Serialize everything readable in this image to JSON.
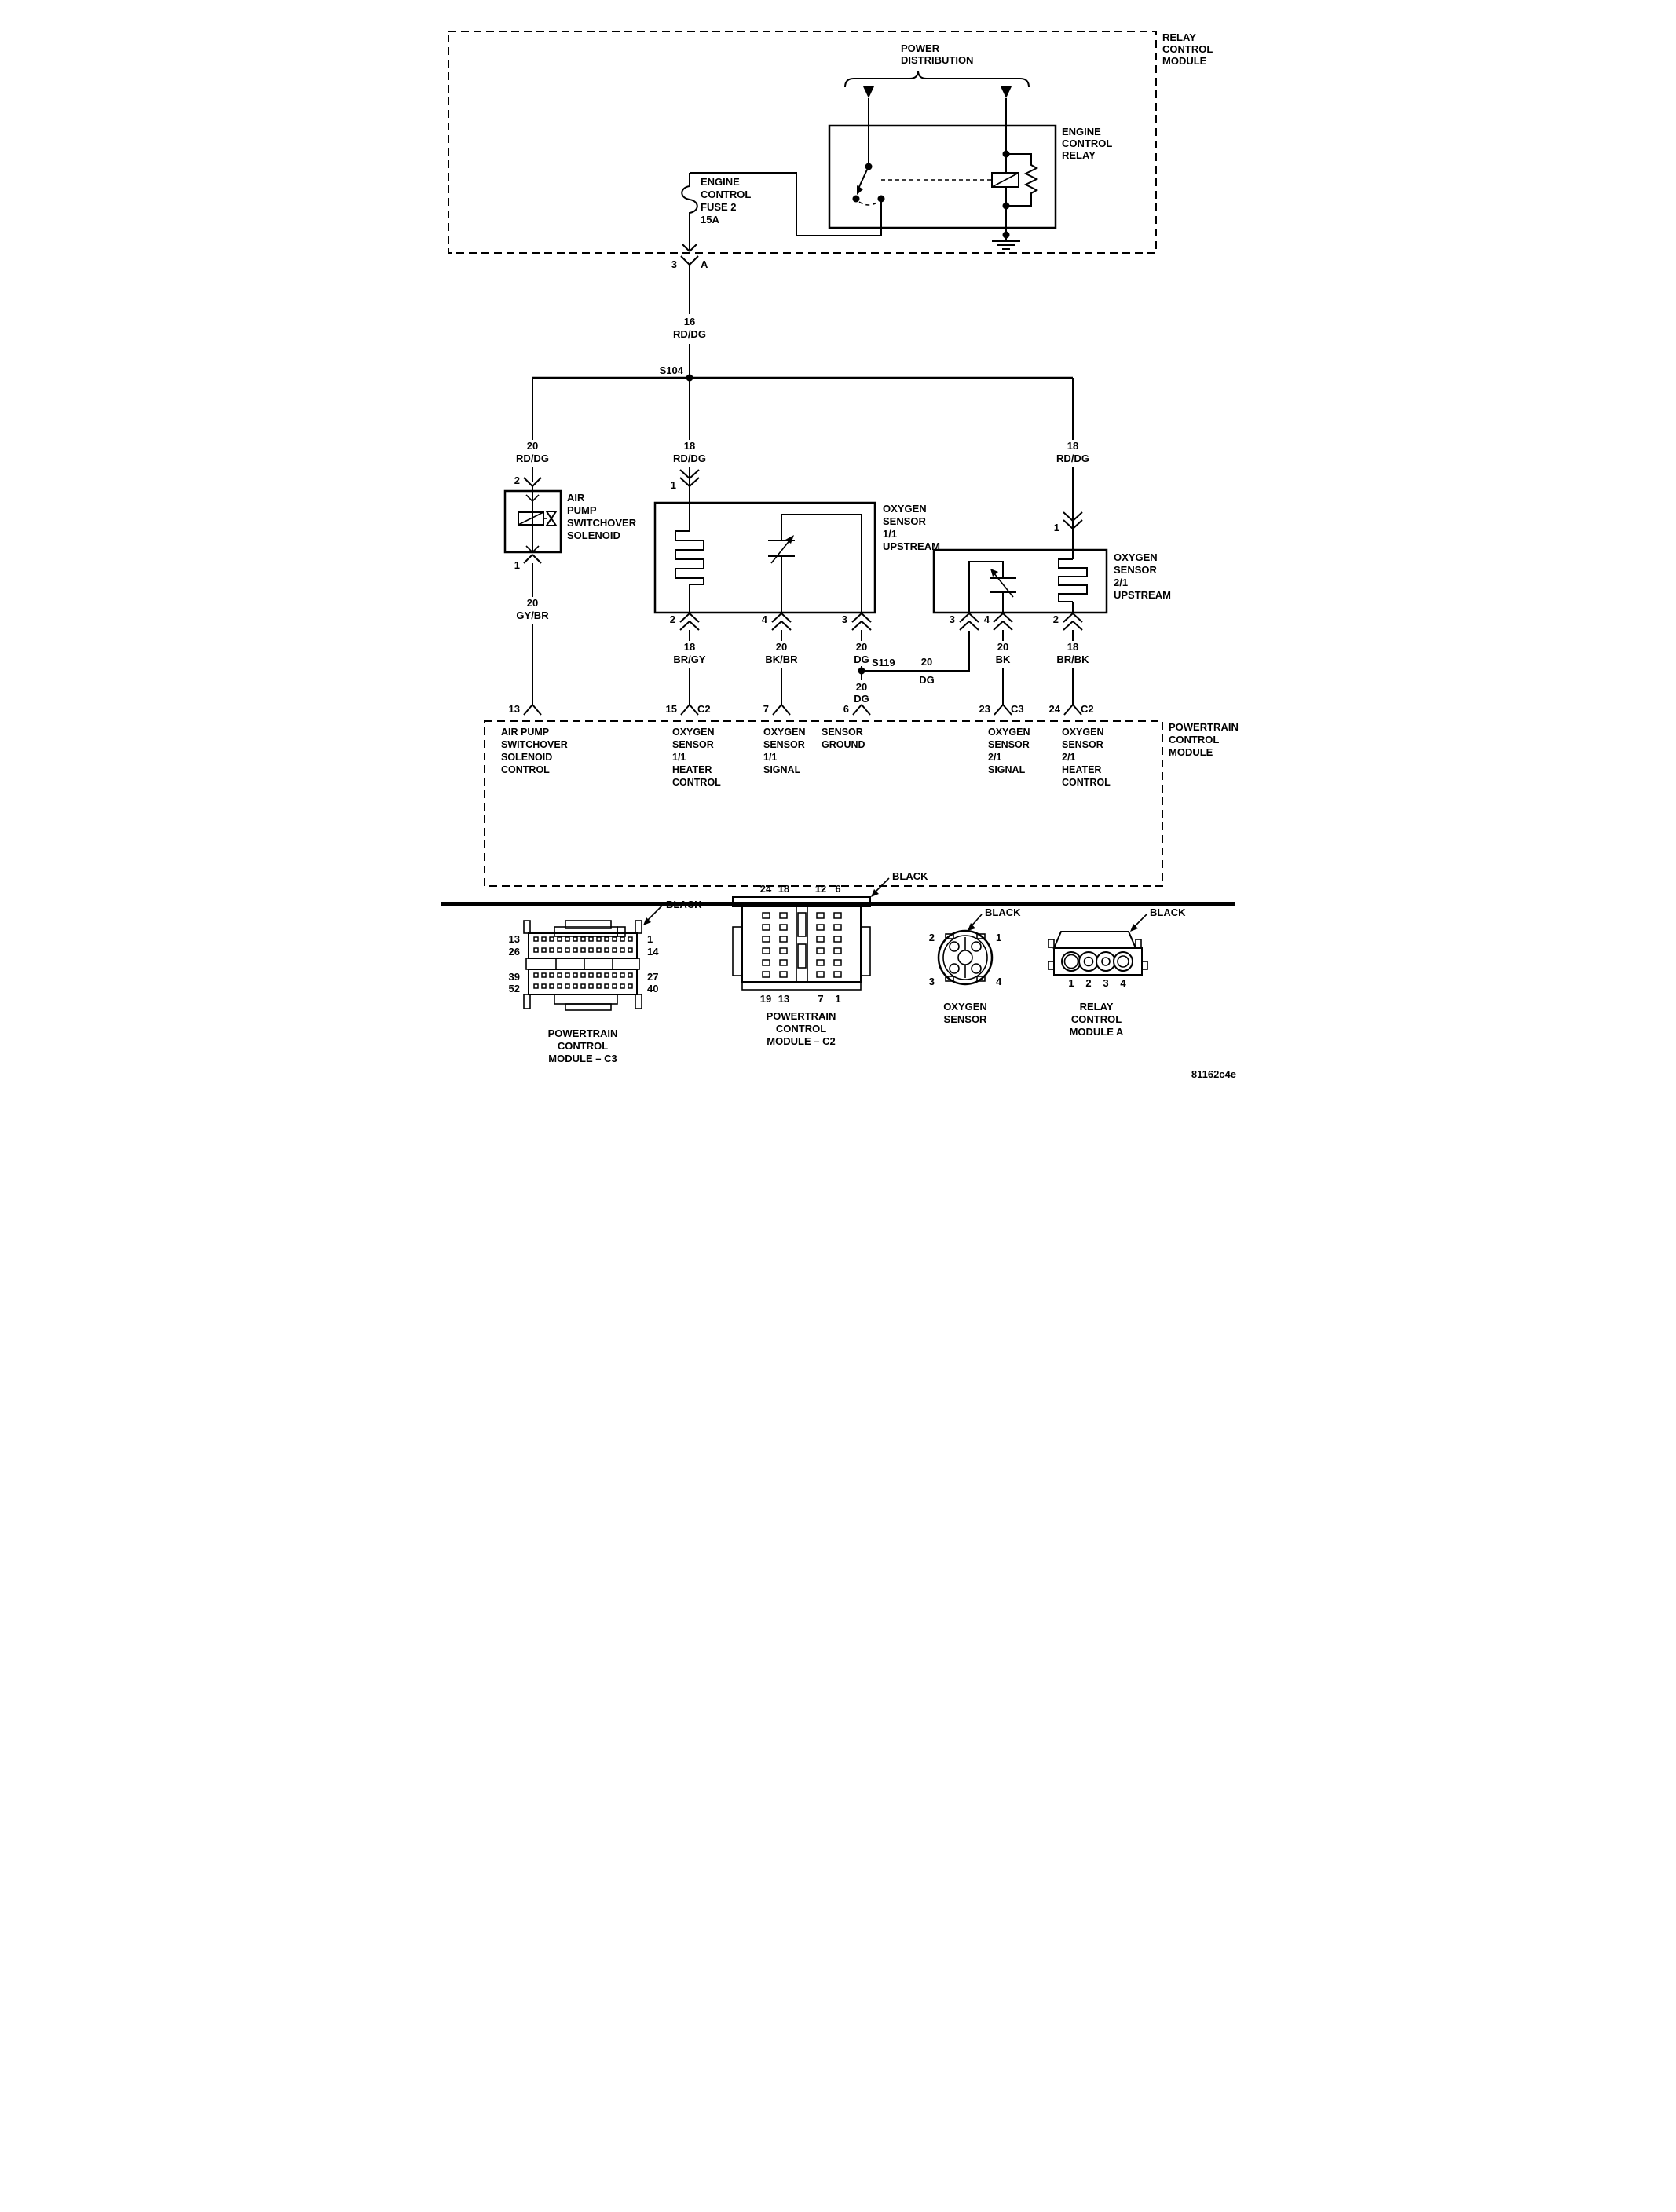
{
  "diagram_code": "81162c4e",
  "relay_control_module": {
    "label": [
      "RELAY",
      "CONTROL",
      "MODULE"
    ]
  },
  "power_distribution": {
    "label": [
      "POWER",
      "DISTRIBUTION"
    ]
  },
  "engine_control_relay": {
    "label": [
      "ENGINE",
      "CONTROL",
      "RELAY"
    ]
  },
  "fuse": {
    "label": [
      "ENGINE",
      "CONTROL",
      "FUSE 2",
      "15A"
    ],
    "exit_pin": "3",
    "exit_cavity": "A"
  },
  "splices": {
    "s104": "S104",
    "s119": "S119"
  },
  "wires": {
    "w16rddg": {
      "gauge": "16",
      "color": "RD/DG"
    },
    "w20rddg": {
      "gauge": "20",
      "color": "RD/DG"
    },
    "w18rddg_mid": {
      "gauge": "18",
      "color": "RD/DG"
    },
    "w18rddg_right": {
      "gauge": "18",
      "color": "RD/DG"
    },
    "w20gybr": {
      "gauge": "20",
      "color": "GY/BR"
    },
    "w18brgy": {
      "gauge": "18",
      "color": "BR/GY"
    },
    "w20bkbr": {
      "gauge": "20",
      "color": "BK/BR"
    },
    "w20dg_a": {
      "gauge": "20",
      "color": "DG"
    },
    "w20dg_b": {
      "gauge": "20",
      "color": "DG"
    },
    "w20dg_c": {
      "gauge": "20",
      "color": "DG"
    },
    "w20bk": {
      "gauge": "20",
      "color": "BK"
    },
    "w18brbk": {
      "gauge": "18",
      "color": "BR/BK"
    }
  },
  "air_pump_solenoid": {
    "label": [
      "AIR",
      "PUMP",
      "SWITCHOVER",
      "SOLENOID"
    ],
    "pin_in": "2",
    "pin_out": "1"
  },
  "o2_sensor_11": {
    "label": [
      "OXYGEN",
      "SENSOR",
      "1/1",
      "UPSTREAM"
    ],
    "pin_supply": "1",
    "pin_heater": "2",
    "pin_signal": "4",
    "pin_ground": "3"
  },
  "o2_sensor_21": {
    "label": [
      "OXYGEN",
      "SENSOR",
      "2/1",
      "UPSTREAM"
    ],
    "pin_supply": "1",
    "pin_ground": "3",
    "pin_signal": "4",
    "pin_heater": "2"
  },
  "pcm": {
    "label": [
      "POWERTRAIN",
      "CONTROL",
      "MODULE"
    ],
    "p13": {
      "pin": "13",
      "function": [
        "AIR PUMP",
        "SWITCHOVER",
        "SOLENOID",
        "CONTROL"
      ]
    },
    "p15": {
      "pin": "15",
      "conn": "C2",
      "function": [
        "OXYGEN",
        "SENSOR",
        "1/1",
        "HEATER",
        "CONTROL"
      ]
    },
    "p7": {
      "pin": "7",
      "function": [
        "OXYGEN",
        "SENSOR",
        "1/1",
        "SIGNAL"
      ]
    },
    "p6": {
      "pin": "6",
      "function": [
        "SENSOR",
        "GROUND"
      ]
    },
    "p23": {
      "pin": "23",
      "conn": "C3",
      "function": [
        "OXYGEN",
        "SENSOR",
        "2/1",
        "SIGNAL"
      ]
    },
    "p24": {
      "pin": "24",
      "conn": "C2",
      "function": [
        "OXYGEN",
        "SENSOR",
        "2/1",
        "HEATER",
        "CONTROL"
      ]
    }
  },
  "connector_views": {
    "pcm_c3": {
      "caption": [
        "POWERTRAIN",
        "CONTROL",
        "MODULE – C3"
      ],
      "color": "BLACK",
      "left_pins": [
        "13",
        "26",
        "39",
        "52"
      ],
      "right_pins": [
        "1",
        "14",
        "27",
        "40"
      ],
      "cols": 13,
      "rows": 4
    },
    "pcm_c2": {
      "caption": [
        "POWERTRAIN",
        "CONTROL",
        "MODULE – C2"
      ],
      "color": "BLACK",
      "top_pins": [
        "24",
        "18",
        "12",
        "6"
      ],
      "bottom_pins": [
        "19",
        "13",
        "7",
        "1"
      ],
      "rows": 6
    },
    "o2": {
      "caption": [
        "OXYGEN",
        "SENSOR"
      ],
      "color": "BLACK",
      "pins": [
        "2",
        "1",
        "3",
        "4"
      ]
    },
    "rcm_a": {
      "caption": [
        "RELAY",
        "CONTROL",
        "MODULE A"
      ],
      "color": "BLACK",
      "pins": [
        "1",
        "2",
        "3",
        "4"
      ]
    }
  }
}
